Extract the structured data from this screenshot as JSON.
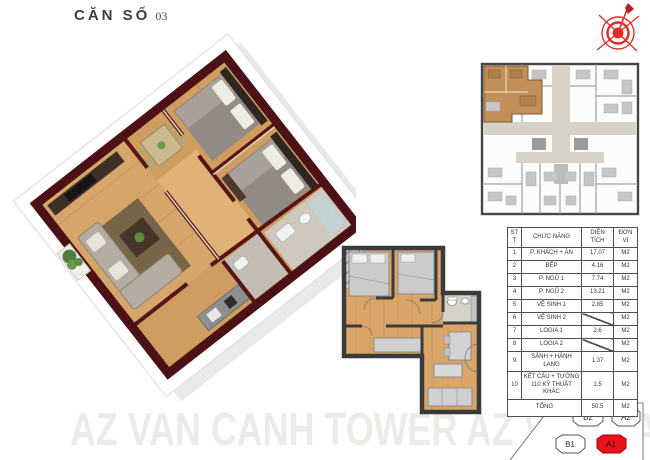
{
  "title": {
    "main": "CĂN SỐ",
    "number": "03"
  },
  "watermark": {
    "text": "AZ VAN CANH TOWER AZ VAN CANH TO"
  },
  "colors": {
    "wall_maroon": "#4c1115",
    "wood_floor": "#cf9d60",
    "plan2d_floor": "#d9a568",
    "plan2d_wall": "#3b3b3b",
    "keyplan_highlight": "#c28f58",
    "keyplan_corridor": "#d8d1c7",
    "accent_red": "#e8131b",
    "compass_red": "#d63029",
    "watermark_gray": "#ecebe7"
  },
  "area_table": {
    "headers": [
      "STT",
      "CHỨC NĂNG",
      "DIỆN TÍCH",
      "ĐƠN VỊ"
    ],
    "rows": [
      {
        "stt": "1",
        "name": "P. KHÁCH + ĂN",
        "area": "17.07",
        "unit": "M2",
        "slash": false
      },
      {
        "stt": "2",
        "name": "BẾP",
        "area": "4.16",
        "unit": "M2",
        "slash": false
      },
      {
        "stt": "3",
        "name": "P. NGỦ 1",
        "area": "7.74",
        "unit": "M2",
        "slash": false
      },
      {
        "stt": "4",
        "name": "P. NGỦ 2",
        "area": "13.21",
        "unit": "M2",
        "slash": false
      },
      {
        "stt": "5",
        "name": "VỆ SINH 1",
        "area": "2.85",
        "unit": "M2",
        "slash": false
      },
      {
        "stt": "6",
        "name": "VỆ SINH 2",
        "area": "",
        "unit": "M2",
        "slash": true
      },
      {
        "stt": "7",
        "name": "LOGIA 1",
        "area": "2.6",
        "unit": "M2",
        "slash": false
      },
      {
        "stt": "8",
        "name": "LOGIA 2",
        "area": "",
        "unit": "M2",
        "slash": true
      },
      {
        "stt": "9",
        "name": "SẢNH + HÀNH LANG",
        "area": "1.37",
        "unit": "M2",
        "slash": false
      },
      {
        "stt": "10",
        "name": "KẾT CẤU + TƯỜNG 110 KỸ THUẬT KHÁC",
        "area": "1.5",
        "unit": "M2",
        "slash": false
      }
    ],
    "total_label": "TỔNG",
    "total_area": "50.5",
    "total_unit": "M2"
  },
  "unit_selector": {
    "units": [
      {
        "label": "B2",
        "active": false
      },
      {
        "label": "A2",
        "active": false
      },
      {
        "label": "B1",
        "active": false
      },
      {
        "label": "A1",
        "active": true
      }
    ],
    "active_color": "#e8131b"
  }
}
